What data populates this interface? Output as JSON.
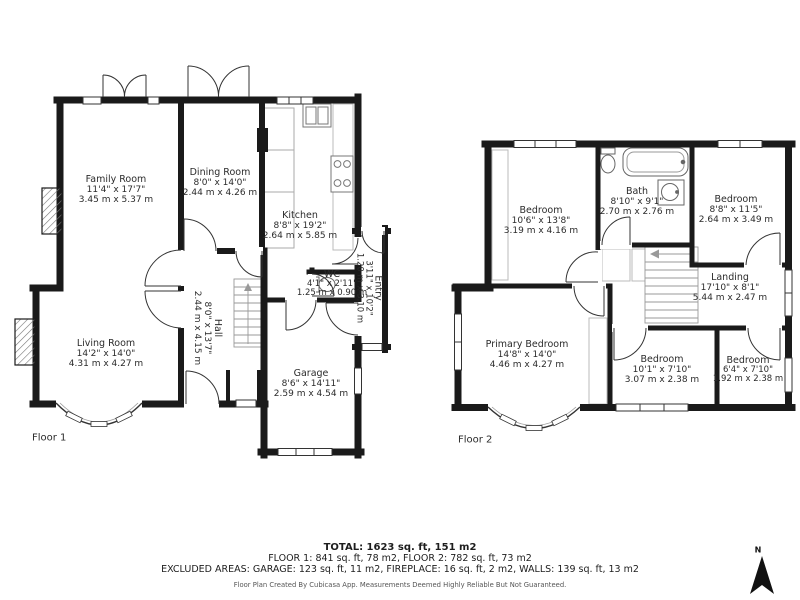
{
  "floor1": {
    "label": "Floor 1",
    "rooms": {
      "family": {
        "name": "Family Room",
        "imperial": "11'4\" x 17'7\"",
        "metric": "3.45 m x 5.37 m"
      },
      "dining": {
        "name": "Dining Room",
        "imperial": "8'0\" x 14'0\"",
        "metric": "2.44 m x 4.26 m"
      },
      "kitchen": {
        "name": "Kitchen",
        "imperial": "8'8\" x 19'2\"",
        "metric": "2.64 m x 5.85 m"
      },
      "living": {
        "name": "Living Room",
        "imperial": "14'2\" x 14'0\"",
        "metric": "4.31 m x 4.27 m"
      },
      "hall": {
        "name": "Hall",
        "imperial": "8'0\" x 13'7\"",
        "metric": "2.44 m x 4.15 m"
      },
      "wc": {
        "name": "WC",
        "imperial": "4'1\" x 2'11\"",
        "metric": "1.25 m x 0.90 m"
      },
      "entry": {
        "name": "Entry",
        "imperial": "3'11\" x 10'2\"",
        "metric": "1.20 m x 3.10 m"
      },
      "garage": {
        "name": "Garage",
        "imperial": "8'6\" x 14'11\"",
        "metric": "2.59 m x 4.54 m"
      }
    }
  },
  "floor2": {
    "label": "Floor 2",
    "rooms": {
      "bedroom1": {
        "name": "Bedroom",
        "imperial": "10'6\" x 13'8\"",
        "metric": "3.19 m x 4.16 m"
      },
      "bath": {
        "name": "Bath",
        "imperial": "8'10\" x 9'1\"",
        "metric": "2.70 m x 2.76 m"
      },
      "bedroom2": {
        "name": "Bedroom",
        "imperial": "8'8\" x 11'5\"",
        "metric": "2.64 m x 3.49 m"
      },
      "landing": {
        "name": "Landing",
        "imperial": "17'10\" x 8'1\"",
        "metric": "5.44 m x 2.47 m"
      },
      "primary": {
        "name": "Primary Bedroom",
        "imperial": "14'8\" x 14'0\"",
        "metric": "4.46 m x 4.27 m"
      },
      "bedroom3": {
        "name": "Bedroom",
        "imperial": "10'1\" x 7'10\"",
        "metric": "3.07 m x 2.38 m"
      },
      "bedroom4": {
        "name": "Bedroom",
        "imperial": "6'4\" x 7'10\"",
        "metric": "1.92 m x 2.38 m"
      }
    }
  },
  "summary": {
    "total": "TOTAL: 1623 sq. ft, 151 m2",
    "floors": "FLOOR 1: 841 sq. ft, 78 m2, FLOOR 2: 782 sq. ft, 73 m2",
    "excluded": "EXCLUDED AREAS: GARAGE: 123 sq. ft, 11 m2, FIREPLACE: 16 sq. ft, 2 m2, WALLS: 139 sq. ft, 13 m2",
    "disclaimer": "Floor Plan Created By Cubicasa App. Measurements Deemed Highly Reliable But Not Guaranteed."
  },
  "compass": {
    "north_label": "N"
  },
  "colors": {
    "wall": "#1a1a1a",
    "text": "#2b2b2b",
    "fixture": "#888888"
  }
}
